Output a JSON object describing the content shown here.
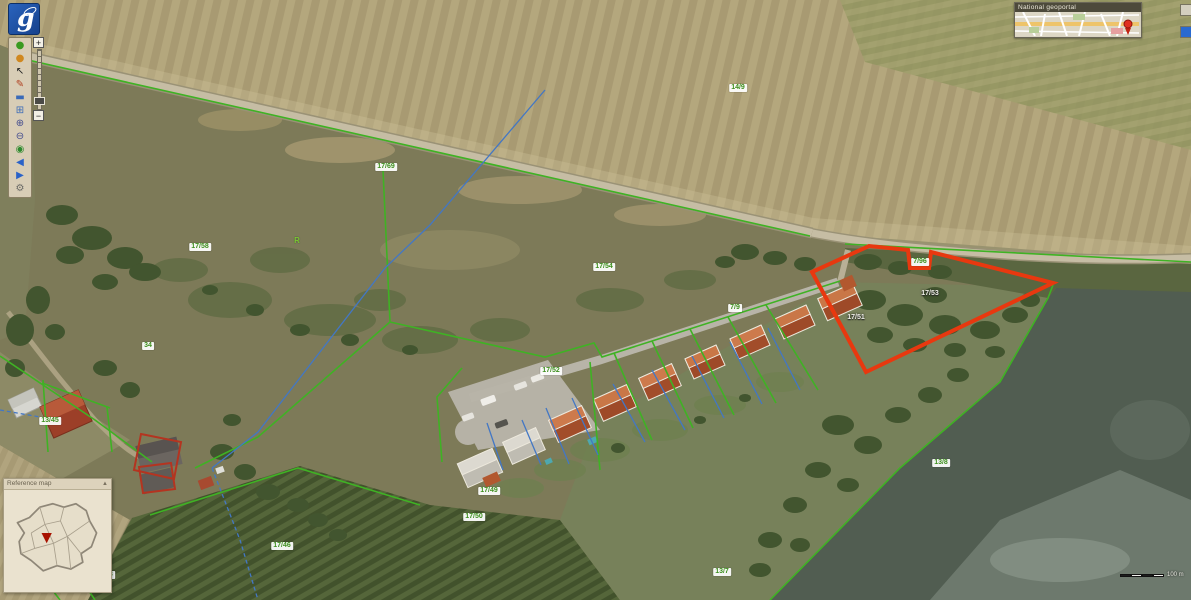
{
  "app": {
    "logo_letter": "g",
    "minimap_title": "National geoportal",
    "overview_title": "Reference map",
    "overview_collapse_glyph": "▲",
    "scale_label": "100 m"
  },
  "colors": {
    "highlight_parcel": "#e8380f",
    "parcel_boundary_green": "#3fb224",
    "utility_line_blue": "#4377c4",
    "building_outline_red": "#b43420",
    "logo_blue": "#2059b0"
  },
  "zoom_slider": {
    "plus": "+",
    "minus": "−"
  },
  "side_buttons": [
    {
      "name": "collapse-minimap-button",
      "glyph": "↗"
    },
    {
      "name": "locate-button",
      "glyph": "■"
    }
  ],
  "toolbar": {
    "buttons": [
      {
        "name": "overview-icon",
        "glyph": "●",
        "color": "#3a9a20"
      },
      {
        "name": "info-icon",
        "glyph": "●",
        "color": "#d08820"
      },
      {
        "name": "select-icon",
        "glyph": "↖",
        "color": "#222222"
      },
      {
        "name": "draw-measure-icon",
        "glyph": "✎",
        "color": "#b04020"
      },
      {
        "name": "ruler-icon",
        "glyph": "▬",
        "color": "#3a6ab8"
      },
      {
        "name": "zoom-window-icon",
        "glyph": "⊞",
        "color": "#3a6ab8"
      },
      {
        "name": "zoom-in-icon",
        "glyph": "⊕",
        "color": "#444d8e"
      },
      {
        "name": "zoom-out-icon",
        "glyph": "⊖",
        "color": "#444d8e"
      },
      {
        "name": "full-extent-icon",
        "glyph": "◉",
        "color": "#2e8a2e"
      },
      {
        "name": "back-icon",
        "glyph": "◀",
        "color": "#2a62c8"
      },
      {
        "name": "forward-icon",
        "glyph": "▶",
        "color": "#2a62c8"
      },
      {
        "name": "settings-icon",
        "glyph": "⚙",
        "color": "#6a6a66"
      }
    ]
  },
  "map": {
    "labels": [
      {
        "x": 738,
        "y": 88,
        "text": "14/9",
        "kind": "box"
      },
      {
        "x": 386,
        "y": 167,
        "text": "17/69",
        "kind": "box"
      },
      {
        "x": 200,
        "y": 247,
        "text": "17/58",
        "kind": "box"
      },
      {
        "x": 604,
        "y": 267,
        "text": "17/54",
        "kind": "box"
      },
      {
        "x": 297,
        "y": 241,
        "text": "R",
        "kind": "green"
      },
      {
        "x": 148,
        "y": 346,
        "text": "34",
        "kind": "box"
      },
      {
        "x": 551,
        "y": 371,
        "text": "17/52",
        "kind": "box"
      },
      {
        "x": 50,
        "y": 421,
        "text": "13/45",
        "kind": "box"
      },
      {
        "x": 735,
        "y": 308,
        "text": "7/9",
        "kind": "box"
      },
      {
        "x": 920,
        "y": 262,
        "text": "7/96",
        "kind": "box"
      },
      {
        "x": 930,
        "y": 294,
        "text": "17/53",
        "kind": "white"
      },
      {
        "x": 856,
        "y": 318,
        "text": "17/51",
        "kind": "white"
      },
      {
        "x": 489,
        "y": 491,
        "text": "17/49",
        "kind": "box"
      },
      {
        "x": 474,
        "y": 517,
        "text": "17/50",
        "kind": "box"
      },
      {
        "x": 282,
        "y": 546,
        "text": "17/46",
        "kind": "box"
      },
      {
        "x": 941,
        "y": 463,
        "text": "13/8",
        "kind": "box"
      },
      {
        "x": 722,
        "y": 572,
        "text": "13/7",
        "kind": "box"
      },
      {
        "x": 37,
        "y": 566,
        "text": "27/5",
        "kind": "box"
      },
      {
        "x": 106,
        "y": 575,
        "text": "27/8",
        "kind": "box"
      }
    ]
  }
}
